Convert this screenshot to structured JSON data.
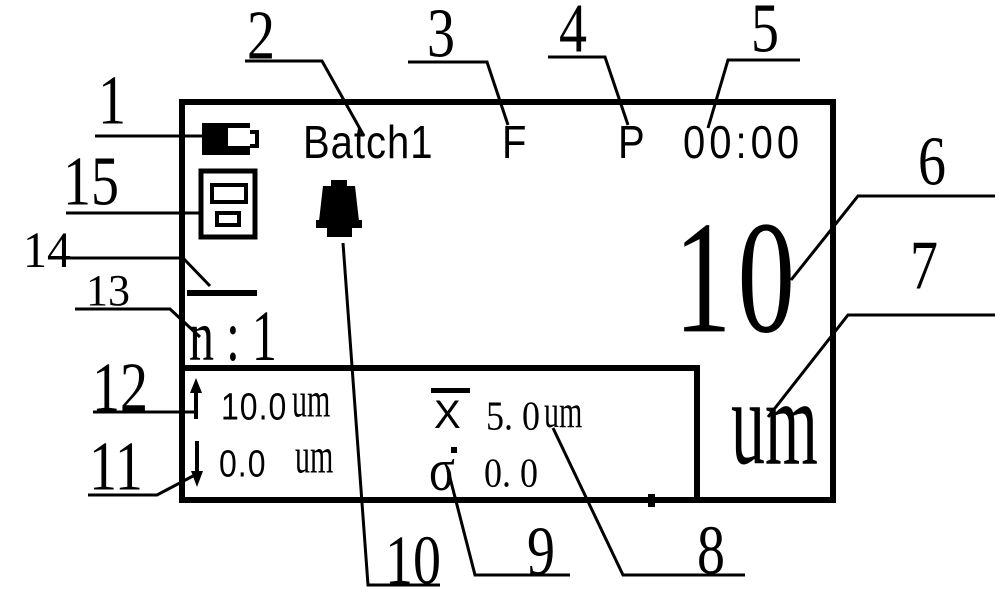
{
  "figure": {
    "description": "Labeled diagram of gauge display screen with numbered callouts",
    "colors": {
      "ink": "#000000",
      "background": "#ffffff"
    }
  },
  "screen": {
    "status": {
      "batch": "Batch1",
      "flag_f": "F",
      "flag_p": "P",
      "time": "00:00"
    },
    "reading": {
      "value": "10",
      "unit": "um"
    },
    "count_label": "n:1",
    "limits": {
      "upper_value": "10.0",
      "upper_unit": "um",
      "lower_value": "0.0",
      "lower_unit": "um"
    },
    "stats": {
      "mean_symbol": "X",
      "mean_value": "5. 0",
      "mean_unit": "um",
      "sigma_symbol": "σ",
      "sigma_value": "0. 0"
    }
  },
  "icons": {
    "battery": "battery-icon",
    "printer": "printer-icon",
    "alarm": "bell-icon",
    "upper_limit_arrow": "arrow-up-icon",
    "lower_limit_arrow": "arrow-down-icon",
    "mean_overline": "overline-bar",
    "separator": "horizontal-bar"
  },
  "callouts": [
    {
      "n": "1",
      "target": "battery-icon"
    },
    {
      "n": "2",
      "target": "batch-label"
    },
    {
      "n": "3",
      "target": "flag-f"
    },
    {
      "n": "4",
      "target": "flag-p"
    },
    {
      "n": "5",
      "target": "time-display"
    },
    {
      "n": "6",
      "target": "reading-value"
    },
    {
      "n": "7",
      "target": "reading-unit"
    },
    {
      "n": "8",
      "target": "mean-value"
    },
    {
      "n": "9",
      "target": "sigma-symbol"
    },
    {
      "n": "10",
      "target": "bell-icon"
    },
    {
      "n": "11",
      "target": "lower-limit"
    },
    {
      "n": "12",
      "target": "upper-limit"
    },
    {
      "n": "13",
      "target": "count-label"
    },
    {
      "n": "14",
      "target": "separator-bar"
    },
    {
      "n": "15",
      "target": "printer-icon"
    }
  ]
}
